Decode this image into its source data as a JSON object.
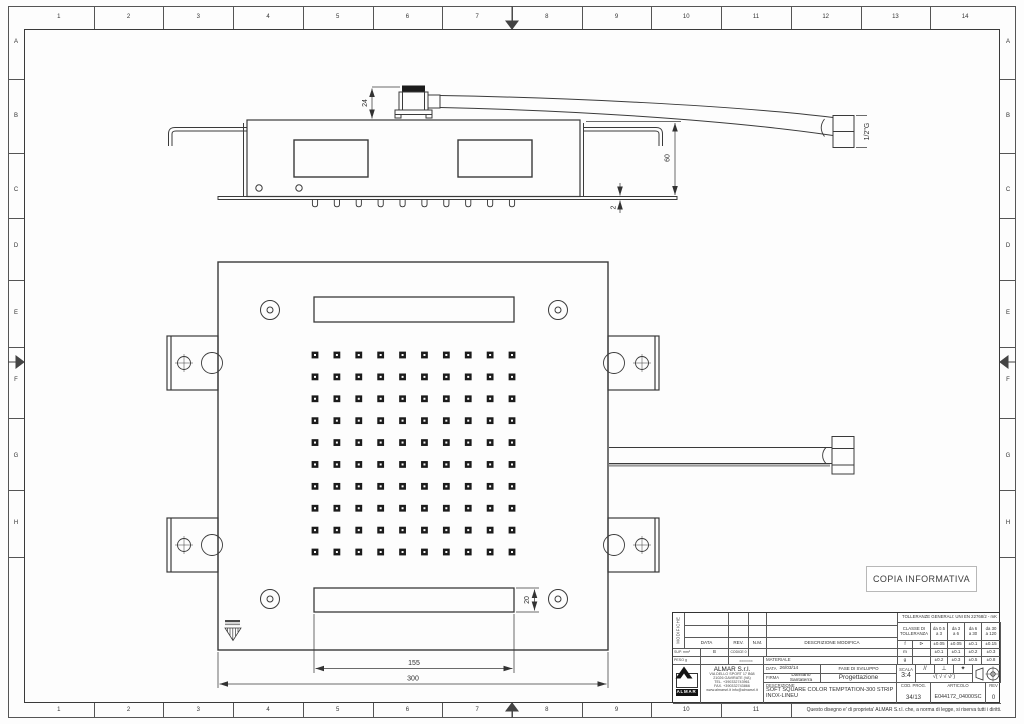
{
  "sheet": {
    "top_numbers": [
      "1",
      "2",
      "3",
      "4",
      "5",
      "6",
      "7",
      "8",
      "9",
      "10",
      "11",
      "12",
      "13",
      "14"
    ],
    "bottom_numbers": [
      "1",
      "2",
      "3",
      "4",
      "5",
      "6",
      "7",
      "8",
      "9",
      "10",
      "11"
    ],
    "side_letters": [
      "A",
      "B",
      "C",
      "D",
      "E",
      "F",
      "G",
      "H"
    ],
    "stamp": "COPIA INFORMATIVA",
    "property_note": "Questo disegno e' di proprieta' ALMAR S.r.l. che, a norma di legge, si riserva tutti i diritti."
  },
  "views": {
    "side": {
      "dim_24": "24",
      "dim_60": "60",
      "dim_2": "2",
      "thread_label": "1/2\"G",
      "nozzle_count": 10
    },
    "front": {
      "dim_slot_width": "155",
      "dim_plate_width": "300",
      "dim_slot_height": "20",
      "nozzle_grid": {
        "rows": 10,
        "cols": 10
      }
    }
  },
  "title_block": {
    "tolerances": {
      "title": "TOLLERANZE GENERALI: UNI EN 22768/2 - mK",
      "class_label": "CLASSE DI TOLLERANZA",
      "ranges": [
        [
          "da 0.5",
          "a 3"
        ],
        [
          "da 3",
          "a 6"
        ],
        [
          "da 6",
          "a 30"
        ],
        [
          "da 30",
          "a 120"
        ]
      ],
      "rows": [
        {
          "cls": "f",
          "sym": "⊳",
          "values": [
            "±0.05",
            "±0.05",
            "±0.1",
            "±0.15"
          ]
        },
        {
          "cls": "m",
          "sym": "",
          "values": [
            "±0.1",
            "±0.1",
            "±0.2",
            "±0.3"
          ]
        },
        {
          "cls": "g",
          "sym": "",
          "values": [
            "±0.2",
            "±0.3",
            "±0.5",
            "±0.8"
          ]
        }
      ]
    },
    "modifications": {
      "side_label": "MODIFICHE",
      "headers": [
        "DATA",
        "REV.",
        "N.M.",
        "DESCRIZIONE MODIFICA"
      ],
      "sup_label": "SUP. mm²",
      "sup_rev": "B",
      "sup_code": "CODICE 0",
      "peso_label": "PESO g",
      "peso_value": "xxxxxxx",
      "materiale_label": "MATERIALE"
    },
    "company": {
      "name": "ALMAR S.r.l.",
      "logo_text": "ALMAR",
      "address_line1": "VIA DELLO SPORT 17 B68",
      "address_line2": "21026 GAVIRATE (VA)",
      "phone": "TEL. +390332743961",
      "fax": "FAX. +390332743866",
      "web": "www.almarsrl.it  info@almarsrl.it"
    },
    "fields": {
      "data_label": "DATA",
      "data_value": "26/03/14",
      "firma_label": "FIRMA",
      "firma_value": "Damiano Santaterra",
      "fase_label": "FASE DI SVILUPPO",
      "fase_value": "Progettazione",
      "descrizione_label": "DESCRIZIONE",
      "descrizione_value": "SOFT SQUARE COLOR TEMPTATION-300 STRIP INOX-LINEU",
      "scala_label": "SCALA",
      "scala_value": "3:4",
      "symbols": [
        "//",
        "⊥",
        "✦"
      ],
      "finish_row": "√( √ √ √∕ )",
      "cod_prog_label": "COD. PROG.",
      "cod_prog_value": "34/13",
      "articolo_label": "ARTICOLO",
      "articolo_value": "E044172_04000SC",
      "rev_label": "REV",
      "rev_value": "0"
    }
  }
}
